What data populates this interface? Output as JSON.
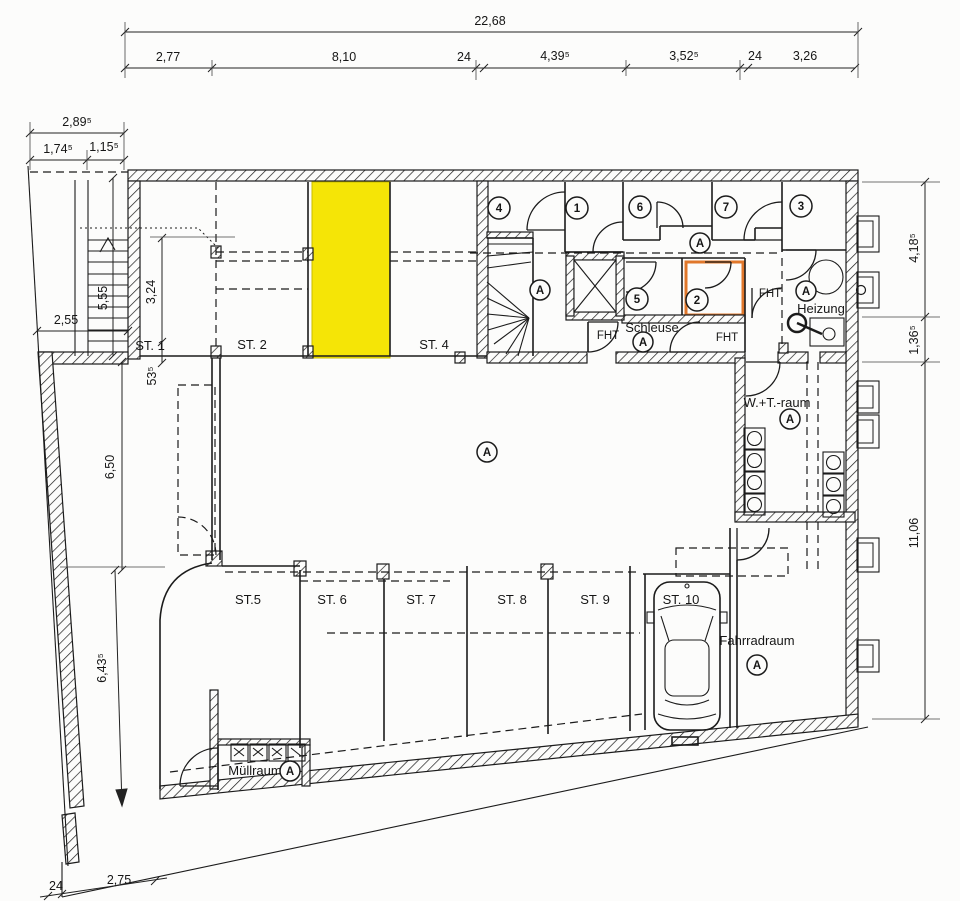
{
  "plan": {
    "type": "floor-plan",
    "highlight_yellow": "#f5e506",
    "highlight_orange": "#e0772b"
  },
  "dims": {
    "top_total": "22,68",
    "top_segments": [
      "2,77",
      "8,10",
      "24",
      "4,39⁵",
      "3,52⁵",
      "24",
      "3,26"
    ],
    "left_top_total": "2,89⁵",
    "left_top_segments": [
      "1,74⁵",
      "1,15⁵"
    ],
    "right_segments": [
      "4,18⁵",
      "1,36⁵",
      "11,06"
    ],
    "left_segments": [
      "5,55",
      "3,24",
      "53⁵",
      "2,55",
      "6,50",
      "6,43⁵"
    ],
    "bottom_segments": [
      "24",
      "2,75"
    ]
  },
  "rooms": {
    "st1": "ST. 1",
    "st2": "ST. 2",
    "st4": "ST. 4",
    "st5": "ST.5",
    "st6": "ST. 6",
    "st7": "ST. 7",
    "st8": "ST. 8",
    "st9": "ST. 9",
    "st10": "ST. 10",
    "schleuse": "Schleuse",
    "heizung": "Heizung",
    "wt_raum": "W.+T.-raum",
    "fahrradraum": "Fahrradraum",
    "muellraum": "Müllraum"
  },
  "labels": {
    "fht": "FHT",
    "zone_a": "A"
  },
  "unit_numbers": [
    "1",
    "2",
    "3",
    "4",
    "5",
    "6",
    "7"
  ]
}
